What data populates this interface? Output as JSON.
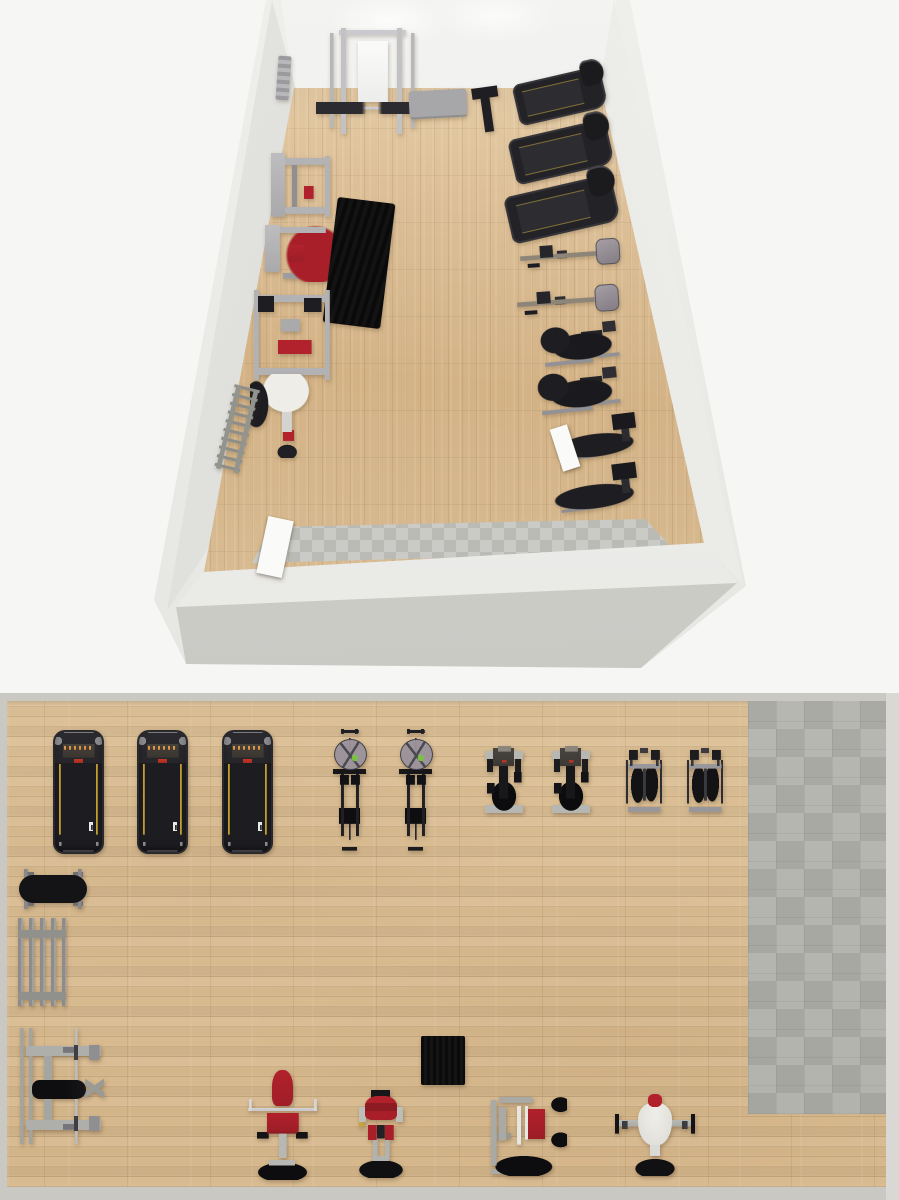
{
  "scene": {
    "kind": "gym-room-planner",
    "views": [
      "3d-perspective-render",
      "2d-top-down-floor-plan"
    ]
  },
  "colors": {
    "background": "#f6f6f5",
    "wall_gray": "#c9c8c3",
    "wall_light": "#d9d8d4",
    "wood": "#dcc096",
    "tile": "#b1b1ab",
    "equipment_black": "#1d1d20",
    "frame_gray": "#a8a8a4",
    "accent_red": "#b1212b",
    "accent_yellow": "#c49f33"
  },
  "inventory": {
    "treadmills": 3,
    "rowing_machines": 2,
    "exercise_bikes": 2,
    "ellipticals": 2,
    "flat_benches": 1,
    "wall_bars": 1,
    "squat_racks_with_bench": 1,
    "preacher_curl_machines": 1,
    "leg_machines": 1,
    "hack_squat_machines": 1,
    "pec_deck_machines": 1,
    "floor_mats": 1
  },
  "view_3d": {
    "equipment": [
      {
        "name": "power-rack",
        "cls": "s3-rack",
        "x": 328,
        "y": 28,
        "w": 88,
        "h": 106,
        "r": 0
      },
      {
        "name": "gray-bench",
        "cls": "s3-benchg",
        "x": 409,
        "y": 90,
        "w": 58,
        "h": 26,
        "r": -3
      },
      {
        "name": "adjustable-bench",
        "cls": "s3-benchb",
        "x": 474,
        "y": 86,
        "w": 26,
        "h": 46,
        "r": -8
      },
      {
        "name": "wall-rack",
        "cls": "s3-wallrack",
        "x": 277,
        "y": 56,
        "w": 13,
        "h": 44,
        "r": 4
      },
      {
        "name": "treadmill-1",
        "cls": "s3-tread",
        "x": 515,
        "y": 75,
        "w": 90,
        "h": 42,
        "r": -13
      },
      {
        "name": "treadmill-2",
        "cls": "s3-tread",
        "x": 511,
        "y": 129,
        "w": 100,
        "h": 46,
        "r": -13
      },
      {
        "name": "treadmill-3",
        "cls": "s3-tread",
        "x": 507,
        "y": 185,
        "w": 110,
        "h": 48,
        "r": -13
      },
      {
        "name": "rowing-machine-1",
        "cls": "s3-rower",
        "x": 518,
        "y": 239,
        "w": 103,
        "h": 30,
        "r": -4
      },
      {
        "name": "rowing-machine-2",
        "cls": "s3-rower",
        "x": 515,
        "y": 285,
        "w": 105,
        "h": 31,
        "r": -4
      },
      {
        "name": "exercise-bike-1",
        "cls": "s3-bike",
        "x": 538,
        "y": 320,
        "w": 88,
        "h": 44,
        "r": -6
      },
      {
        "name": "exercise-bike-2",
        "cls": "s3-bike",
        "x": 535,
        "y": 366,
        "w": 92,
        "h": 46,
        "r": -6
      },
      {
        "name": "elliptical-1",
        "cls": "s3-ell",
        "x": 554,
        "y": 414,
        "w": 97,
        "h": 46,
        "r": -7
      },
      {
        "name": "elliptical-2",
        "cls": "s3-ell",
        "x": 551,
        "y": 464,
        "w": 101,
        "h": 48,
        "r": -7
      },
      {
        "name": "lat-machine",
        "cls": "s3-latm",
        "x": 268,
        "y": 148,
        "w": 64,
        "h": 76,
        "r": 0
      },
      {
        "name": "shoulder-machine",
        "cls": "s3-shoulder",
        "x": 262,
        "y": 218,
        "w": 74,
        "h": 64,
        "r": 0
      },
      {
        "name": "gym-mat",
        "cls": "s3-mat",
        "x": 330,
        "y": 200,
        "w": 58,
        "h": 126,
        "r": 7
      },
      {
        "name": "bench-machine",
        "cls": "s3-rowm",
        "x": 252,
        "y": 290,
        "w": 80,
        "h": 90,
        "r": 0
      },
      {
        "name": "pec-deck-machine",
        "cls": "s3-pec",
        "x": 250,
        "y": 374,
        "w": 62,
        "h": 84,
        "r": 0
      },
      {
        "name": "wall-bars",
        "cls": "s3-wallbars",
        "x": 224,
        "y": 386,
        "w": 26,
        "h": 86,
        "r": 14
      },
      {
        "name": "door-left",
        "cls": "s3-door",
        "x": 262,
        "y": 518,
        "w": 26,
        "h": 58,
        "r": 12
      },
      {
        "name": "door-right",
        "cls": "s3-door",
        "x": 556,
        "y": 426,
        "w": 18,
        "h": 44,
        "r": -18
      }
    ]
  },
  "plan_2d": {
    "tile_area": {
      "x": 748,
      "y": 8,
      "w": 138,
      "h": 413
    },
    "equipment": [
      {
        "name": "treadmill-1",
        "cls": "s2-tread",
        "x": 53,
        "y": 37,
        "w": 51,
        "h": 124
      },
      {
        "name": "treadmill-2",
        "cls": "s2-tread",
        "x": 137,
        "y": 37,
        "w": 51,
        "h": 124
      },
      {
        "name": "treadmill-3",
        "cls": "s2-tread",
        "x": 222,
        "y": 37,
        "w": 51,
        "h": 124
      },
      {
        "name": "rowing-machine-1",
        "cls": "s2-rower",
        "x": 333,
        "y": 36,
        "w": 33,
        "h": 122
      },
      {
        "name": "rowing-machine-2",
        "cls": "s2-rower",
        "x": 399,
        "y": 36,
        "w": 33,
        "h": 122
      },
      {
        "name": "exercise-bike-1",
        "cls": "s2-bike",
        "x": 485,
        "y": 50,
        "w": 38,
        "h": 70
      },
      {
        "name": "exercise-bike-2",
        "cls": "s2-bike",
        "x": 552,
        "y": 50,
        "w": 38,
        "h": 70
      },
      {
        "name": "elliptical-1",
        "cls": "s2-ell",
        "x": 626,
        "y": 54,
        "w": 37,
        "h": 66
      },
      {
        "name": "elliptical-2",
        "cls": "s2-ell",
        "x": 687,
        "y": 54,
        "w": 37,
        "h": 66
      },
      {
        "name": "flat-bench",
        "cls": "s2-bench",
        "x": 18,
        "y": 176,
        "w": 74,
        "h": 40
      },
      {
        "name": "wall-bars",
        "cls": "s2-wallbars",
        "x": 18,
        "y": 225,
        "w": 48,
        "h": 88
      },
      {
        "name": "squat-rack-with-bench",
        "cls": "s2-squat",
        "x": 19,
        "y": 335,
        "w": 89,
        "h": 116
      },
      {
        "name": "preacher-curl-machine",
        "cls": "s2-preacher",
        "x": 248,
        "y": 377,
        "w": 69,
        "h": 110
      },
      {
        "name": "leg-machine",
        "cls": "s2-legm",
        "x": 358,
        "y": 395,
        "w": 46,
        "h": 90
      },
      {
        "name": "floor-mat",
        "cls": "s2-mat",
        "x": 421,
        "y": 343,
        "w": 44,
        "h": 49
      },
      {
        "name": "hack-squat-machine",
        "cls": "s2-hack",
        "x": 487,
        "y": 399,
        "w": 80,
        "h": 84
      },
      {
        "name": "pec-deck-machine",
        "cls": "s2-pec",
        "x": 615,
        "y": 401,
        "w": 80,
        "h": 82
      }
    ]
  }
}
